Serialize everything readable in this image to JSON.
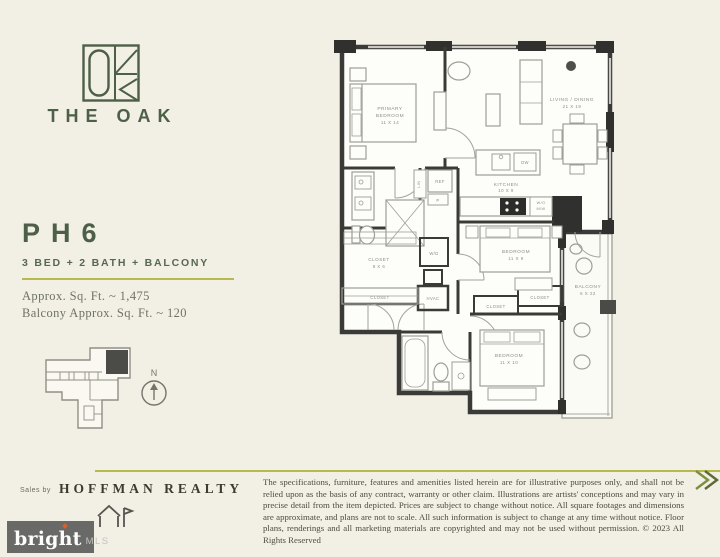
{
  "brand": {
    "name": "THE OAK"
  },
  "unit": {
    "number": "PH6",
    "subtitle": "3 BED + 2 BATH + BALCONY",
    "sqft": "Approx. Sq. Ft. ~ 1,475",
    "balcony_sqft": "Balcony Approx. Sq. Ft. ~ 120"
  },
  "keyplan": {
    "north": "N"
  },
  "floorplan": {
    "rooms": [
      {
        "lines": [
          "PRIMARY",
          "BEDROOM",
          "11 X 14"
        ]
      },
      {
        "lines": [
          "LIVING / DINING",
          "21 X 19"
        ]
      },
      {
        "lines": [
          "KITCHEN",
          "10 X 9"
        ]
      },
      {
        "lines": [
          "BEDROOM",
          "11 X 9"
        ]
      },
      {
        "lines": [
          "BEDROOM",
          "11 X 10"
        ]
      },
      {
        "lines": [
          "BALCONY",
          "6 X 22"
        ]
      },
      {
        "lines": [
          "CLOSET",
          "8 X 6"
        ]
      }
    ],
    "small_labels": {
      "closet": "CLOSET",
      "wd": "W/D",
      "hvac": "HVAC",
      "ref": "REF",
      "dw": "DW",
      "wall_oven": "W/O",
      "microwave": "M/W",
      "pantry": "P",
      "linen": "LIN"
    }
  },
  "footer": {
    "sales_by": "Sales by",
    "brokerage": "HOFFMAN REALTY",
    "disclaimer": "The specifications, furniture, features and amenities listed herein are for illustrative purposes only, and shall not be relied upon as the basis of any contract, warranty or other claim. Illustrations are artists' conceptions and may vary in precise detail from the item depicted. Prices are subject to change without notice. All square footages and dimensions are approximate, and plans are not to scale. All such information is subject to change at any time without notice. Floor plans, renderings and all marketing materials are copyrighted and may not be used without permission. © 2023 All Rights Reserved"
  },
  "watermark": {
    "name": "bright",
    "suffix": "MLS"
  },
  "colors": {
    "background": "#f2efe5",
    "accent_green": "#4d5f47",
    "olive_line": "#b7b84d",
    "wall_dark": "#3a3a38",
    "furniture_gray": "#9f9f98",
    "label_gray": "#8e8e87",
    "watermark_bg": "#696967",
    "watermark_spark": "#d95f2b"
  }
}
